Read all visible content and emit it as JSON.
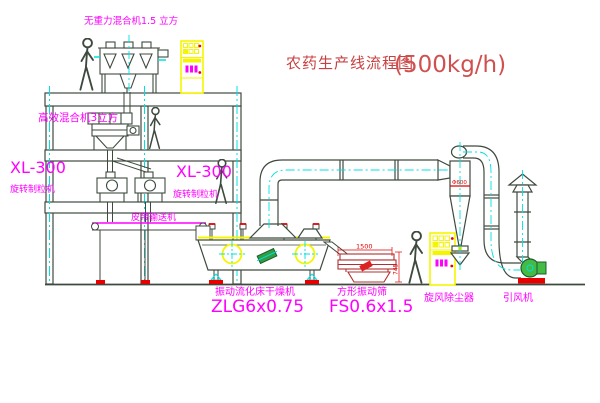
{
  "title": {
    "cn": "农药生产线流程图",
    "capacity": "(500kg/h)"
  },
  "labels": {
    "top_mixer": "无重力混合机1.5 立方",
    "eff_mixer": "高效混合机3立方",
    "xl300_left": "XL-300",
    "granulator_left": "旋转制粒机",
    "xl300_mid": "XL-300",
    "granulator_mid": "旋转制粒机",
    "belt_conveyor": "皮带输送机",
    "dryer": "振动流化床干燥机",
    "dryer_model": "ZLG6x0.75",
    "sieve": "方形振动筛",
    "sieve_model": "FS0.6x1.5",
    "cyclone": "旋风除尘器",
    "fan": "引风机"
  },
  "dimensions": {
    "sieve_width": "1500",
    "sieve_height": "745",
    "cyclone_note": "Φ600"
  },
  "colors": {
    "label_magenta": "#ff00ff",
    "title_red": "#c84040",
    "line": "#3f4a3f",
    "cabinet_yellow": "#f5f500",
    "centerline_cyan": "#00e0e0",
    "accent_red": "#e80000",
    "motor_green": "#2f9e44",
    "sieve_red": "#b03030"
  }
}
